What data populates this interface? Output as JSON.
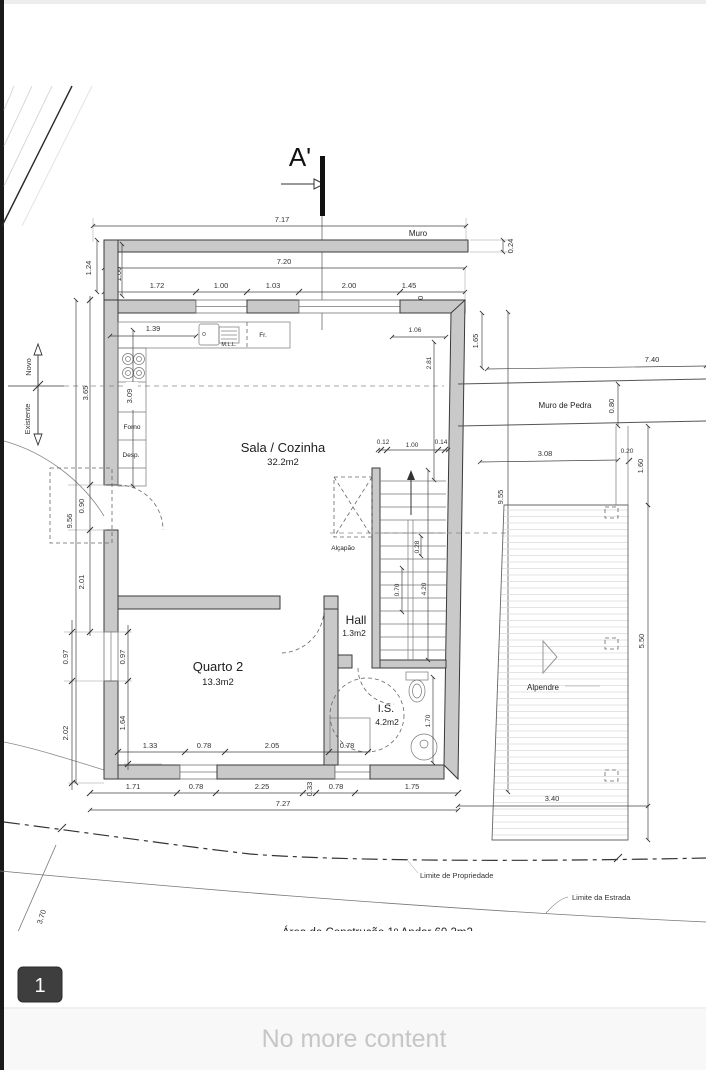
{
  "viewer": {
    "page_badge": "1",
    "footer_text": "No more content"
  },
  "colors": {
    "wall_fill": "#c9c9c9",
    "badge_bg": "#3e3e3e",
    "footer_bg": "#f8f8f8",
    "footer_text": "#c6c6c6"
  },
  "plan": {
    "section_marker": "A'",
    "labels": {
      "muro": "Muro",
      "muro_pedra": "Muro de Pedra",
      "novo": "Novo",
      "existente": "Existente",
      "sala": "Sala / Cozinha",
      "sala_area": "32.2m2",
      "quarto": "Quarto 2",
      "quarto_area": "13.3m2",
      "hall": "Hall",
      "hall_area": "1.3m2",
      "is": "I.S.",
      "is_area": "4.2m2",
      "alpendre": "Alpendre",
      "alcapao": "Alçapão",
      "forno": "Forno",
      "desp": "Desp.",
      "mll": "M.L.L.",
      "fr": "Fr.",
      "lim_prop": "Limite de Propriedade",
      "lim_estrada": "Limite da Estrada",
      "area_constr": "Área de Construção   1º Andar    60.2m2"
    },
    "dims": {
      "d717": "7.17",
      "d024": "0.24",
      "d720": "7.20",
      "d172": "1.72",
      "d100": "1.00",
      "d103": "1.03",
      "d200": "2.00",
      "d145": "1.45",
      "d030": "0.30",
      "d124": "1.24",
      "d365": "3.65",
      "d956": "9.56",
      "d090": "0.90",
      "d201": "2.01",
      "d097": "0.97",
      "d202": "2.02",
      "d164": "1.64",
      "d309": "3.09",
      "d139": "1.39",
      "d106": "1.06",
      "d165": "1.65",
      "d281": "2.81",
      "d012": "0.12",
      "d014": "0.14",
      "d028": "0.28",
      "d070": "0.70",
      "d420": "4.20",
      "d955": "9.55",
      "d740": "7.40",
      "d080": "0.80",
      "d308": "3.08",
      "d020": "0.20",
      "d160": "1.60",
      "d550": "5.50",
      "d340": "3.40",
      "d133": "1.33",
      "d078": "0.78",
      "d205": "2.05",
      "d170": "1.70",
      "d171": "1.71",
      "d225": "2.25",
      "d033": "0.33",
      "d175": "1.75",
      "d727": "7.27",
      "d370": "3.70"
    }
  }
}
